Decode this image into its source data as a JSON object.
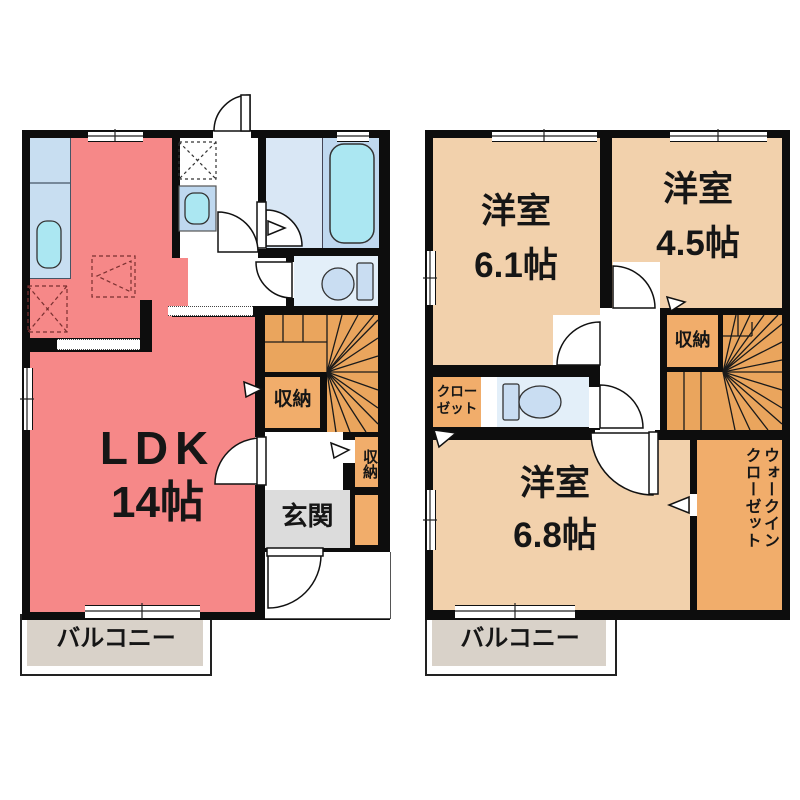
{
  "colors": {
    "wall": "#0d0d0d",
    "ldk": "#F68888",
    "room": "#F2D1AC",
    "stairs": "#EAA55D",
    "storage": "#F1AD6B",
    "entrance": "#DCDCDC",
    "balcony": "#D9D2C9",
    "bath_floor": "#D9E7F5",
    "bath_panel": "#BFD8EF",
    "water": "#ABE7F2",
    "toilet_room": "#E3EFF9",
    "counter": "#C8DEF1",
    "fixture": "#C9DDF2"
  },
  "floor1": {
    "ldk_name": "LDK",
    "ldk_size": "14帖",
    "storage_main": "収納",
    "storage_small": "収納",
    "entrance": "玄関",
    "balcony": "バルコニー"
  },
  "floor2": {
    "rooms": [
      {
        "name": "洋室",
        "size": "6.1帖"
      },
      {
        "name": "洋室",
        "size": "4.5帖"
      },
      {
        "name": "洋室",
        "size": "6.8帖"
      }
    ],
    "storage": "収納",
    "closet_line1": "クロー",
    "closet_line2": "ゼット",
    "wic_line1": "ウォークイン",
    "wic_line2": "クローゼット",
    "balcony": "バルコニー"
  }
}
